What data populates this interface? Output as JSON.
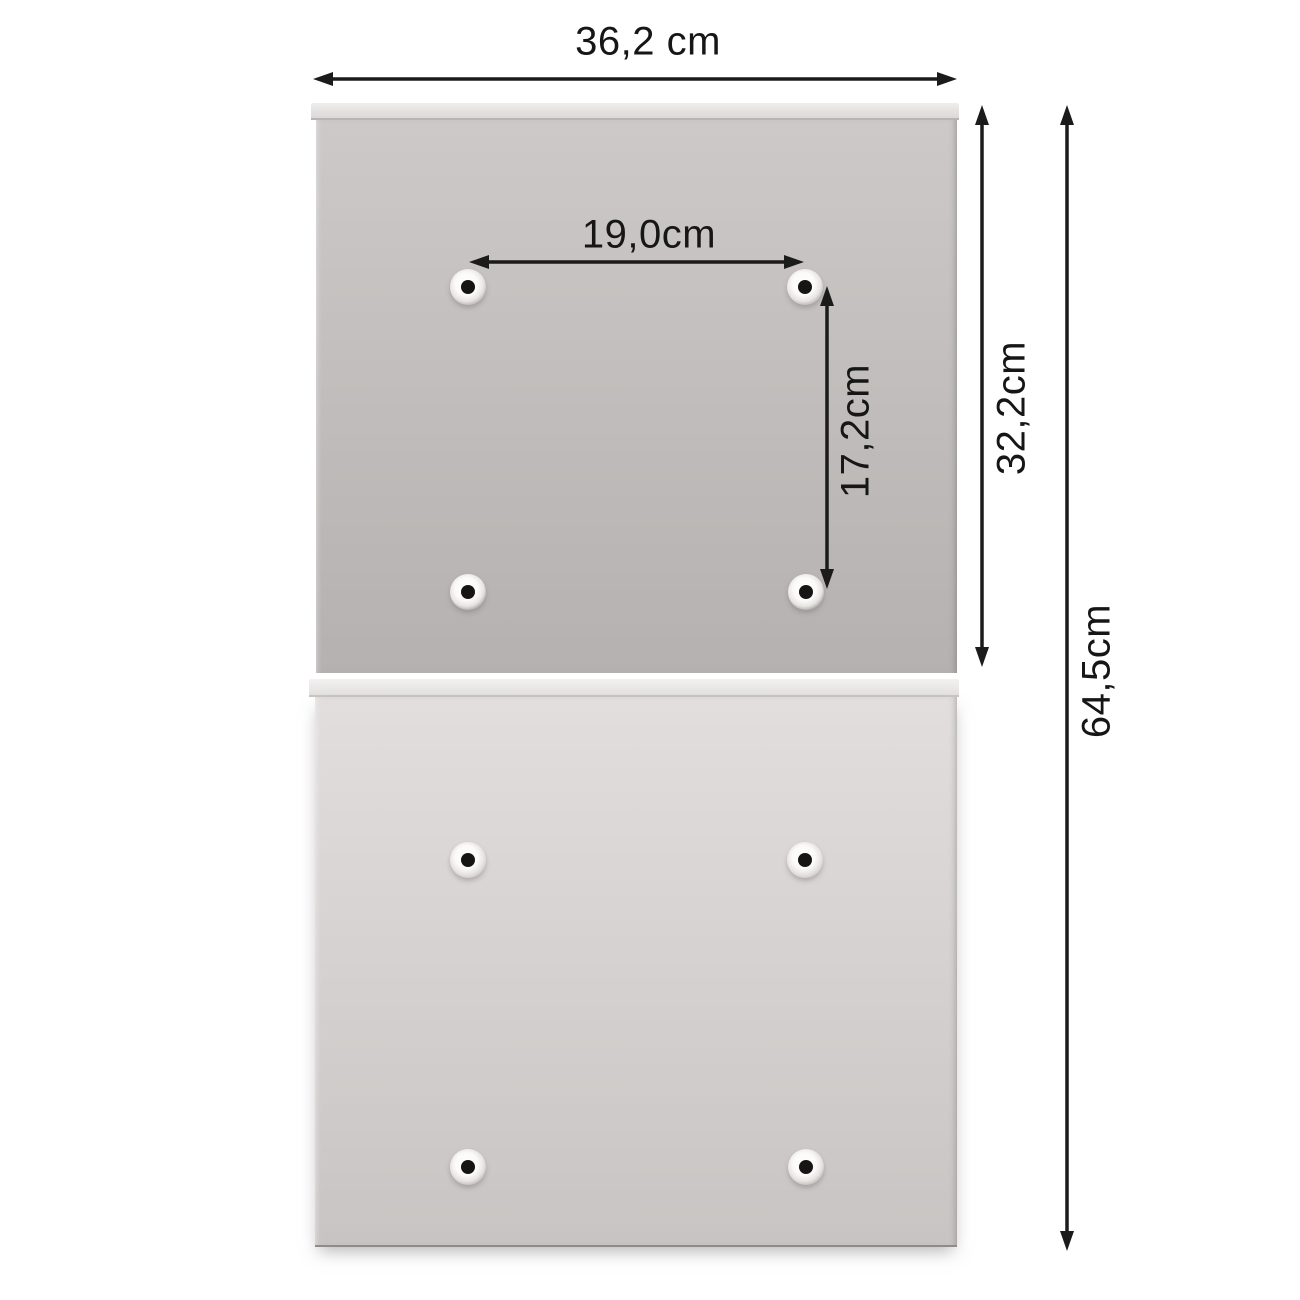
{
  "diagram": {
    "title": "safe mounting dimensions",
    "dimensions": {
      "overall_width": "36,2 cm",
      "hole_spacing_horizontal": "19,0cm",
      "hole_spacing_vertical": "17,2cm",
      "upper_panel_height": "32,2cm",
      "total_height": "64,5cm"
    },
    "colors": {
      "background": "#ffffff",
      "arrow": "#1b1b1b",
      "label_text": "#161616",
      "upper_panel_top": "#ccc9c8",
      "upper_panel_bottom": "#b5b1b0",
      "lower_panel_top": "#e1dedd",
      "lower_panel_bottom": "#c8c4c3",
      "panel_lip": "#efeeed",
      "hole_dot": "#161414"
    },
    "holes_per_panel": 4,
    "panel_count": 2
  }
}
